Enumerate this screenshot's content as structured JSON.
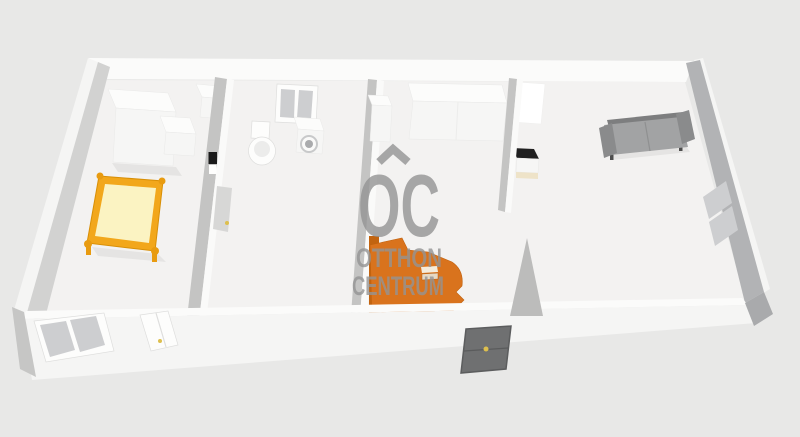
{
  "watermark": {
    "logo_text": "OC",
    "line1": "OTTHON",
    "line2": "CENTRUM",
    "roof_icon": "house-roof-chevron"
  },
  "colors": {
    "background": "#e8e8e7",
    "floor": "#f3f2f1",
    "wall_white": "#fbfbfa",
    "wall_shade_gray": "#d2d2d1",
    "right_wall_gray": "#b2b3b5",
    "window_glass": "#cdced0",
    "bed_frame_yellow": "#f2a71b",
    "bed_mattress_yellow": "#fbf3c2",
    "bed_post_yellow": "#e89b10",
    "bed_orange": "#d9731d",
    "bed_orange_dark": "#c26410",
    "pillow_cream": "#f4ecdc",
    "sofa_gray": "#a2a3a4",
    "sofa_back_gray": "#7d7e7f",
    "sofa_arm_gray": "#8a8b8c",
    "sofa_leg_gray": "#4e4e4e",
    "door_gray": "#6f7071",
    "door_frame_gray": "#5c5d5e",
    "handle_yellow": "#ddbf4e",
    "nightstand_top_black": "#202020",
    "nightstand_base_cream": "#eee3c8",
    "switch_black": "#1a1a1a",
    "machine_door_gray": "#aaabad",
    "watermark_gray": "#949494"
  },
  "scene": {
    "view": "3d-floor-plan-render",
    "furniture_visible": [
      "wardrobe",
      "corner-cabinet",
      "child-bed-yellow",
      "wall-switch",
      "bathroom-window",
      "toilet",
      "washing-machine",
      "tall-cabinet",
      "kitchen-counter",
      "double-bed-orange",
      "entrance-door",
      "white-wardrobe-panel",
      "nightstand",
      "sofa",
      "facade-windows",
      "terrace-door"
    ]
  }
}
